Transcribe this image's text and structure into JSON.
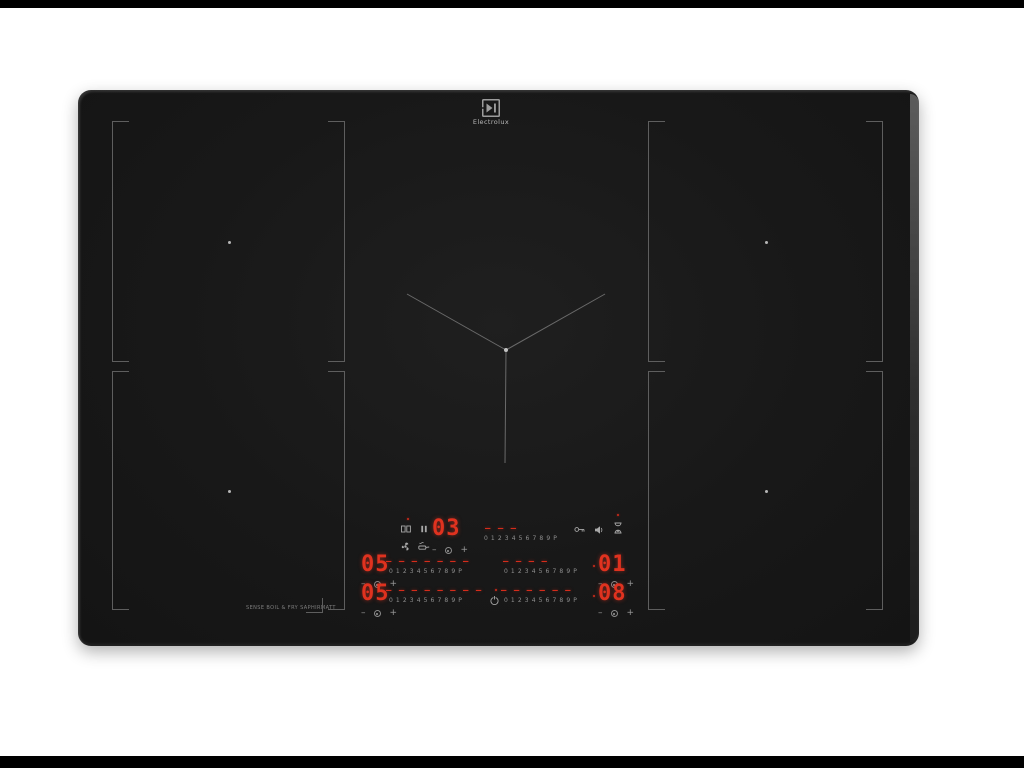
{
  "scene": {
    "background": "#ffffff",
    "letterbox_color": "#000000"
  },
  "hob": {
    "brand": "Electrolux",
    "body_color": "#181818",
    "zone_line_color": "#5e5e5e",
    "led_color": "#e0321f",
    "scale_text_color": "#8f8f8f",
    "icon_color": "#a8a8a8"
  },
  "panel": {
    "scale": "0 1 2 3 4 5 6 7 8 9 P",
    "minus": "–",
    "plus": "+",
    "timer": {
      "value": "03",
      "dashes": "– – –"
    },
    "zones": {
      "left_mid": {
        "value": "05",
        "dashes": "– – – – – – –"
      },
      "right_mid": {
        "value": "01",
        "dashes": "– – – –"
      },
      "left_bottom": {
        "value": "05",
        "dashes": "– – – – – – – –"
      },
      "right_bottom": {
        "value": "08",
        "dashes": "– – – – – –"
      }
    },
    "footer_label": "SENSE BOIL & FRY SAPHIRMATT",
    "icons": {
      "bridge": "two linked rectangles",
      "pause": "❚❚",
      "hob2hood": "fan",
      "sense_fry": "pan",
      "key_lock": "key",
      "sound": "speaker",
      "timer": "hourglass",
      "power": "⏻"
    }
  }
}
